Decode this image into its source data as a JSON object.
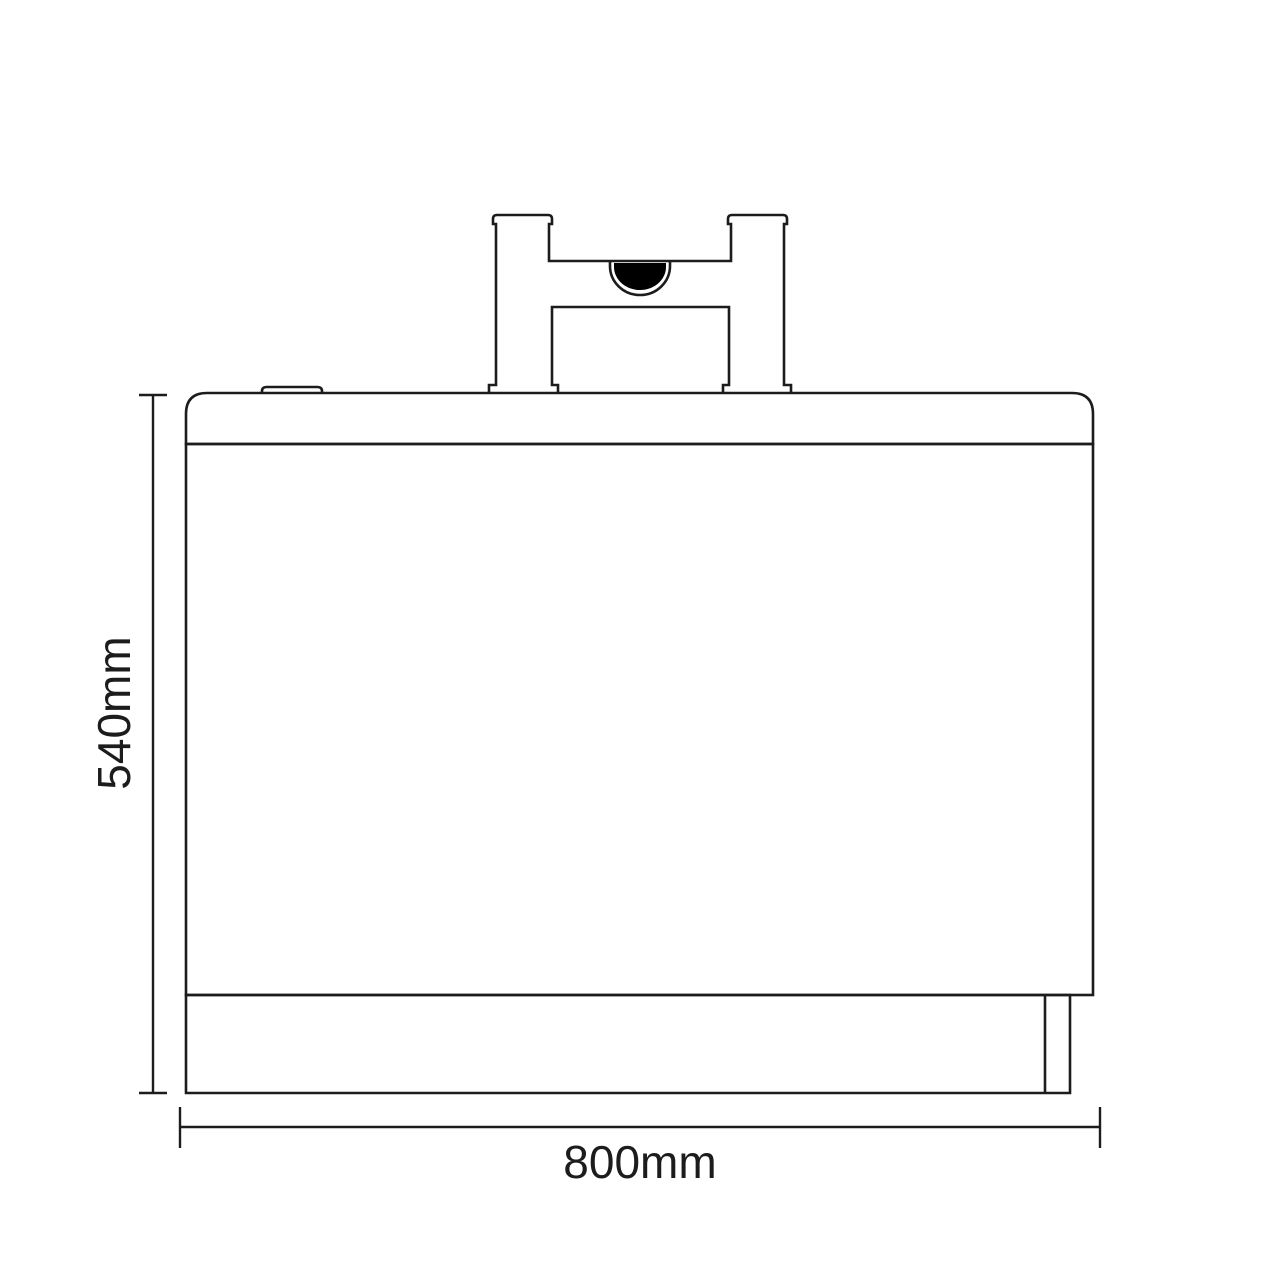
{
  "drawing": {
    "name": "bath-front-elevation-with-tap",
    "background_color": "#ffffff",
    "line_color": "#1c1c1c",
    "spout_fill_color": "#000000"
  },
  "dimensions": {
    "height": {
      "label": "540mm"
    },
    "width": {
      "label": "800mm"
    }
  }
}
